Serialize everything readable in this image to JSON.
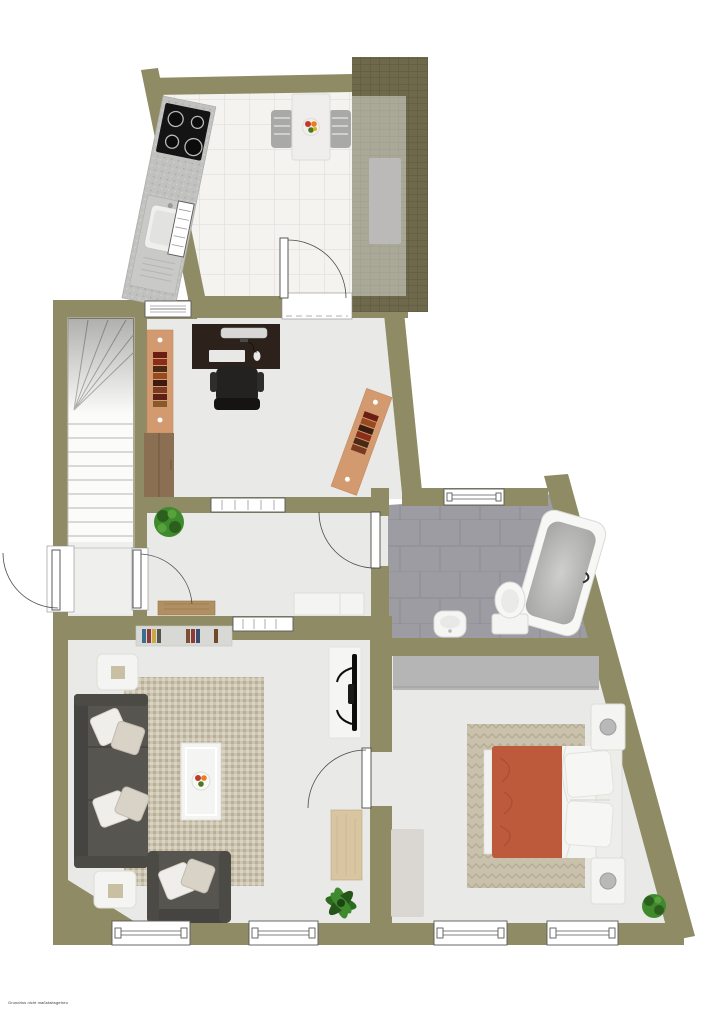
{
  "meta": {
    "type": "floor-plan",
    "view": "top-down-3d-render",
    "fine_print": "Grundriss nicht maßstabsgetreu"
  },
  "colors": {
    "wall": "#8f8b64",
    "terrace_tile": "#6d694a",
    "terrace_line": "#5b5840",
    "kitchen_floor": "#f4f3f0",
    "kitchen_line": "#e0dfdb",
    "floor": "#e9e9e8",
    "vestibule_floor": "#efefed",
    "stairs": "#fbfbfa",
    "bath_tile": "#9c9ca2",
    "bath_line": "#8d8d94",
    "rug_living": "#cdc5b0",
    "rug_bed": "#c9c1ab",
    "rug_bed_line": "#b3a991",
    "rug_side": "#dad7d2",
    "sofa": "#57554f",
    "sofa_dark": "#454440",
    "pillow": "#f0eeea",
    "bed_duvet": "#bd5a3c",
    "bed_duvet_dark": "#a64e33",
    "white_furniture": "#f4f4f2",
    "wood_bench": "#b08f62",
    "wood_table": "#d8c5a1",
    "shelf_salmon": "#d49a6f",
    "desk_brown": "#2c221b",
    "chair_black": "#232220",
    "counter_gray": "#c1c1bf",
    "cooktop_black": "#141414",
    "wardrobe_gray": "#b5b5b5",
    "chair_gray": "#a9a9a7",
    "mat_gray": "#8f8f8f",
    "plant_green": "#3f8a2d",
    "plant_dark": "#2c5e1d",
    "door_stroke": "#4a4a4a",
    "window_stroke": "#5a5a5a"
  },
  "rooms": [
    {
      "name": "kitchen",
      "floor": "white-tile",
      "furniture": [
        "counter-with-cooktop",
        "sink-unit",
        "dining-table",
        "dining-chair-left",
        "dining-chair-right",
        "fruit-bowl"
      ]
    },
    {
      "name": "terrace",
      "floor": "dark-olive-tile",
      "furniture": [
        "gray-mat"
      ]
    },
    {
      "name": "office",
      "floor": "light-gray",
      "furniture": [
        "desk",
        "monitor",
        "keyboard",
        "mouse",
        "office-chair",
        "bookshelf-left",
        "cabinet",
        "bookshelf-angled"
      ]
    },
    {
      "name": "staircase",
      "furniture": [
        "winder-stairs"
      ]
    },
    {
      "name": "hallway",
      "furniture": [
        "potted-plant",
        "wood-bench",
        "sideboard"
      ]
    },
    {
      "name": "bathroom",
      "floor": "gray-tile",
      "furniture": [
        "bathtub",
        "toilet",
        "bidet-sink"
      ]
    },
    {
      "name": "living-room",
      "floor": "light-gray",
      "furniture": [
        "wall-shelf-books",
        "sectional-sofa",
        "armchair",
        "side-table-top",
        "side-table-bottom",
        "area-rug",
        "coffee-tray",
        "fruit-bowl",
        "tv-panel",
        "wood-side-table",
        "potted-plant"
      ]
    },
    {
      "name": "bedroom",
      "floor": "light-gray",
      "furniture": [
        "wardrobe",
        "double-bed",
        "nightstand-top",
        "nightstand-bottom",
        "herringbone-rug",
        "side-rug",
        "potted-plant"
      ]
    }
  ],
  "doors": [
    "front-door",
    "vestibule-door",
    "kitchen-door",
    "bathroom-door",
    "bedroom-door"
  ],
  "windows": [
    "office-top-window",
    "kitchen-side-window",
    "hall-top-window",
    "hall-bottom-window",
    "bathroom-window",
    "living-window-1",
    "living-window-2",
    "bedroom-window-1",
    "bedroom-window-2"
  ]
}
